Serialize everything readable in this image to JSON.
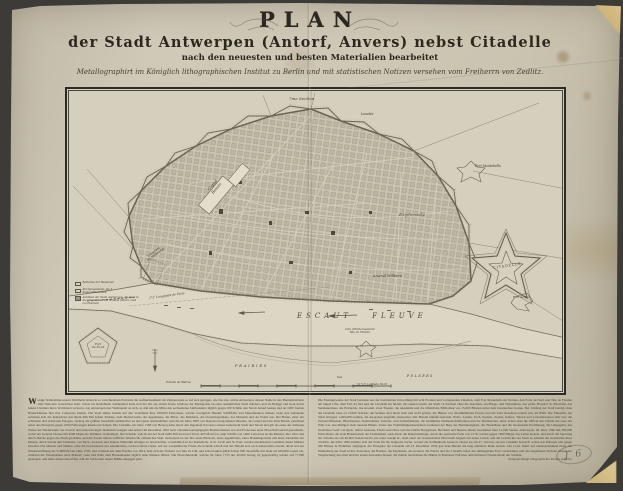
{
  "title": {
    "main": "PLAN",
    "line2": "der Stadt Antwerpen (Antorf, Anvers) nebst Citadelle",
    "line3": "nach den neuesten und besten Materialien bearbeitet",
    "line4": "Metallographirt im Königlich lithographischen Institut zu Berlin und mit statistischen Notizen versehen vom Freiherrn von Zedlitz."
  },
  "map": {
    "labels": {
      "section_top": "7me Section",
      "lunette": "Lunette",
      "fort_montebello": "Fort Montebello",
      "grand_bassin": "Grand\nBassin",
      "esplanade": "Esplanade",
      "citadelle": "CITADELLE",
      "arsenal": "Arsenal Militaire",
      "cimetiere": "Cimetière\ndu Kattendyk",
      "fort_du_nord": "Fort\ndu Nord",
      "fort_du_sud": "Fort du Sud",
      "cote_embarquement": "Côte d'Embarquement\nTête de Flandre",
      "escaut": "ESCAUT  FLEUVE",
      "prairies": "PRAIRIES",
      "polders": "POLDERS",
      "iles": "Iles",
      "latitude": "51°13′ Latitude Nord",
      "longitude": "2°3′ Longitude de Paris",
      "scale": "Échelle de Mètres"
    },
    "legend": {
      "items": [
        {
          "text": "Batterien der Bastionen"
        },
        {
          "text": "Kirchengebäude, die 3 Kommunikationen"
        },
        {
          "text": "Anhöhen der Stadt Antwerpen, die über die Citadelle an die Schelde führen, sind zu erkennen"
        }
      ]
    }
  },
  "notes": {
    "drop_cap": "W",
    "left_column": "enige Städteplätze unsers Welttheils haben in so verschiedenen Perioden die Aufmerksamkeit der Zeitgenossen so auf sich gezogen, wie das alte, reiche Antwerpen, dessen Name in den Handelsbüchern aller Nationen verzeichnet steht. Schon im dreizehnten Jahrhundert hatte sich der Ort aus einem festen Schlosse der Markgrafen zu einer ansehnlichen Stadt erhoben, und als Brügge und Gent durch innere Unruhen ihren Wohlstand verloren, zog Antwerpen den Welthandel an sich, so daß um die Mitte des sechzehnten Jahrhunderts täglich gegen 500 Schiffe den Strom herauf kamen und an 1000 fremde Handelshäuser hier ihre Comptoire hielten. Die Stadt zählte damals mit den Vorstädten über 200,000 Einwohner, welche vorzüglich Handel, Schifffahrt und Manufakturen trieben; unter den Gebäuden zeichnen sich die Kathedrale mit ihrem 466 Fuß hohen Thurme, dem Meisterwerke des Appelmans, die Börse, das Rathhaus, das Oosterlingenhaus, das Museum und der Palast aus. Der Hafen, einer der schönsten und sichersten Europas, vermag die größten Seeschiffe unmittelbar an den Quais aufzunehmen, und die im Jahre 1803 von Napoleon begonnenen Bassins, das Grand und das Petit Bassin, gewähren nebst den Entrepôts gegen 1000 Fahrzeugen Raum und Schutz. Die Citadelle, im Jahre 1568 von Herzog Alba durch den Ingenieur Pacciotto erbaut, beherrscht Stadt und Strom und gilt als eines der stärksten Werke der Niederlande; sie ward in den letzten Kriegen mehrmals belagert und zuletzt im December 1832 nach vierundzwanzigtägigem Bombardement von den Franzosen unter Marschall Gérard genommen, wobei der General Chassé mit 4500 Mann die Trümmer vertheidigte. Die Schelde, welche bei der Stadt 2400 Fuß breit und 30 bis 40 Fuß tief ist, trägt Schiffe von 1400 Lasten bis an die Mauern; ihre Ufer sind durch Deiche gegen die Fluth geschützt, und die Polder liefern treffliche Weiden für zahlreiches Vieh. Antwerpen ist der Sitz eines Bischofs, eines Appellhofes, eines Handelsgerichts und einer Akademie der Künste, deren Schule durch Rubens, van Dyck, Jordaens und Teniers Weltruhm erlangte; in den Kirchen, vornehmlich in der Kathedrale, in St. Jacob und St. Paul, werden unschätzbare Gemälde dieser Meister bewahrt. Die Messen und Märkte, einst die besuchtesten des Abendlandes, verloren ihren Glanz, seit der westphälische Friede die Schelde schloß und der Handel sich nach Amsterdam wandte; allein seit der Wiedereröffnung der Schifffahrt im Jahre 1795, und vollends seit dem Frieden von 1814, hebt sich der Verkehr von Jahr zu Jahr, und schon laufen jährlich über 900 Seeschiffe mit mehr als 100,000 Lasten ein, während die Eisenbahnen nach Brüssel, Gent und Köln dem Binnenhandel täglich neue Bahnen öffnen. Die Einwohnerzahl, welche im Jahre 1755 nur 40,000 betrug, ist gegenwärtig wieder auf 77,000 gestiegen, und Alles deutet darauf hin, daß die Stadt einer neuen Blüthe entgegen geht.",
    "right_column": "Die Festungswerke der Stadt bestehen aus der bastionirten Umwallung mit acht Fronten und vorliegenden Lünetten, dem Fort Montebello im Norden, den Forts du Nord und Tête de Flandre am linken Ufer, dem Fort du Sud und der Citadelle im Süden; im Ganzen besitzt die Stadt 12 Kirchen ohne die Kapellen, ein Pflege- und Waisenhaus, das große Hospital St. Elisabeth, das Seemannshaus, die Entrepôts, das Arsenal, zwei Theater, die Akademie und die öffentliche Bibliothek von 15,000 Bänden nebst dem botanischen Garten. Der Umfang der Stadt beträgt ohne die Citadelle nahe an 13,000 Schritte; die Straßen sind meist breit und wohl gebaut, die Häuser von alterthümlicher Pracht, und die Zahl derselben beläuft sich auf 8500. Die Einkünfte der Stadt betragen 1,400,000 Gulden, die Ausgaben ungefähr ebensoviel. Der Handel umfaßt Getreide, Wolle, Leinen, Tuch, Spitzen, Zucker, Kaffee, Taback und Colonialwaaren aller Art; die Zuckerraffinerien, Bleichereien, Seilerbahnen, Tabacks- und Seifenfabriken, die berühmten Diamantschleifereien und die Druckereien, unter denen einst die Officin des Plantin die erste der Welt war, beschäftigen viele tausend Hände. Unter den Wohlthätigkeitsanstalten verdienen der Berg der Barmherzigkeit, das Findelhaus und die Irrenanstalt Erwähnung; die Umgegend, das fruchtbare Land von Ryen, liefert Getreide, Flachs und Obst, und die Dörfer Borgerhout, Berchem und Deurne zählen zusammen über 12,000 Seelen. Antwerpen, im Jahre 1566 mit 200,000 Einwohnern die erste Handelsstadt der Christenheit, sank durch die Religionskriege, durch die spanische Furie von 1576, welche gegen 7000 Bürger das Leben kostete, und durch die Sperrung der Schelde bis auf 40,000 Seelen herab; erst unter Joseph II., dann unter der französischen Herrschaft begann ein neues Leben, und die Geschichte der Stadt ist seitdem die Geschichte ihres Stromes. Im Jahre 1830 erklärte sich die Stadt für die belgische Sache, worauf der holländische General Chassé sie am 27. October aus der Citadelle beschoß, wobei das Entrepôt und gegen 200 Häuser in Flammen aufgingen; die Übergabe der Citadelle am 23. December 1832 gab dem Handel die lang entbehrte Ruhe zurück. Der Leser findet auf nebenstehendem Plane die Eintheilung der Stadt in ihre Sectionen, die Bassins, die Esplanade, das Arsenal, die Werfte und die Citadelle nebst den umliegenden Forts verzeichnet, und die beigefügten Notizen mögen zur Vergleichung des alten und des neuen Zustandes dienen; die Zahlen bezeichnen die Höhen in Brabanter Fuß über dem mittleren Wasserstande der Schelde.",
    "imprint": "Verlag des Königl. lithographischen Instituts zu Berlin."
  },
  "annotations": {
    "pencil_mark": "J 6"
  },
  "colors": {
    "paper": "#cdc6b3",
    "ink": "#2e2a22",
    "hand_color_stain": "#a97f2a",
    "background": "#3c3b38"
  }
}
